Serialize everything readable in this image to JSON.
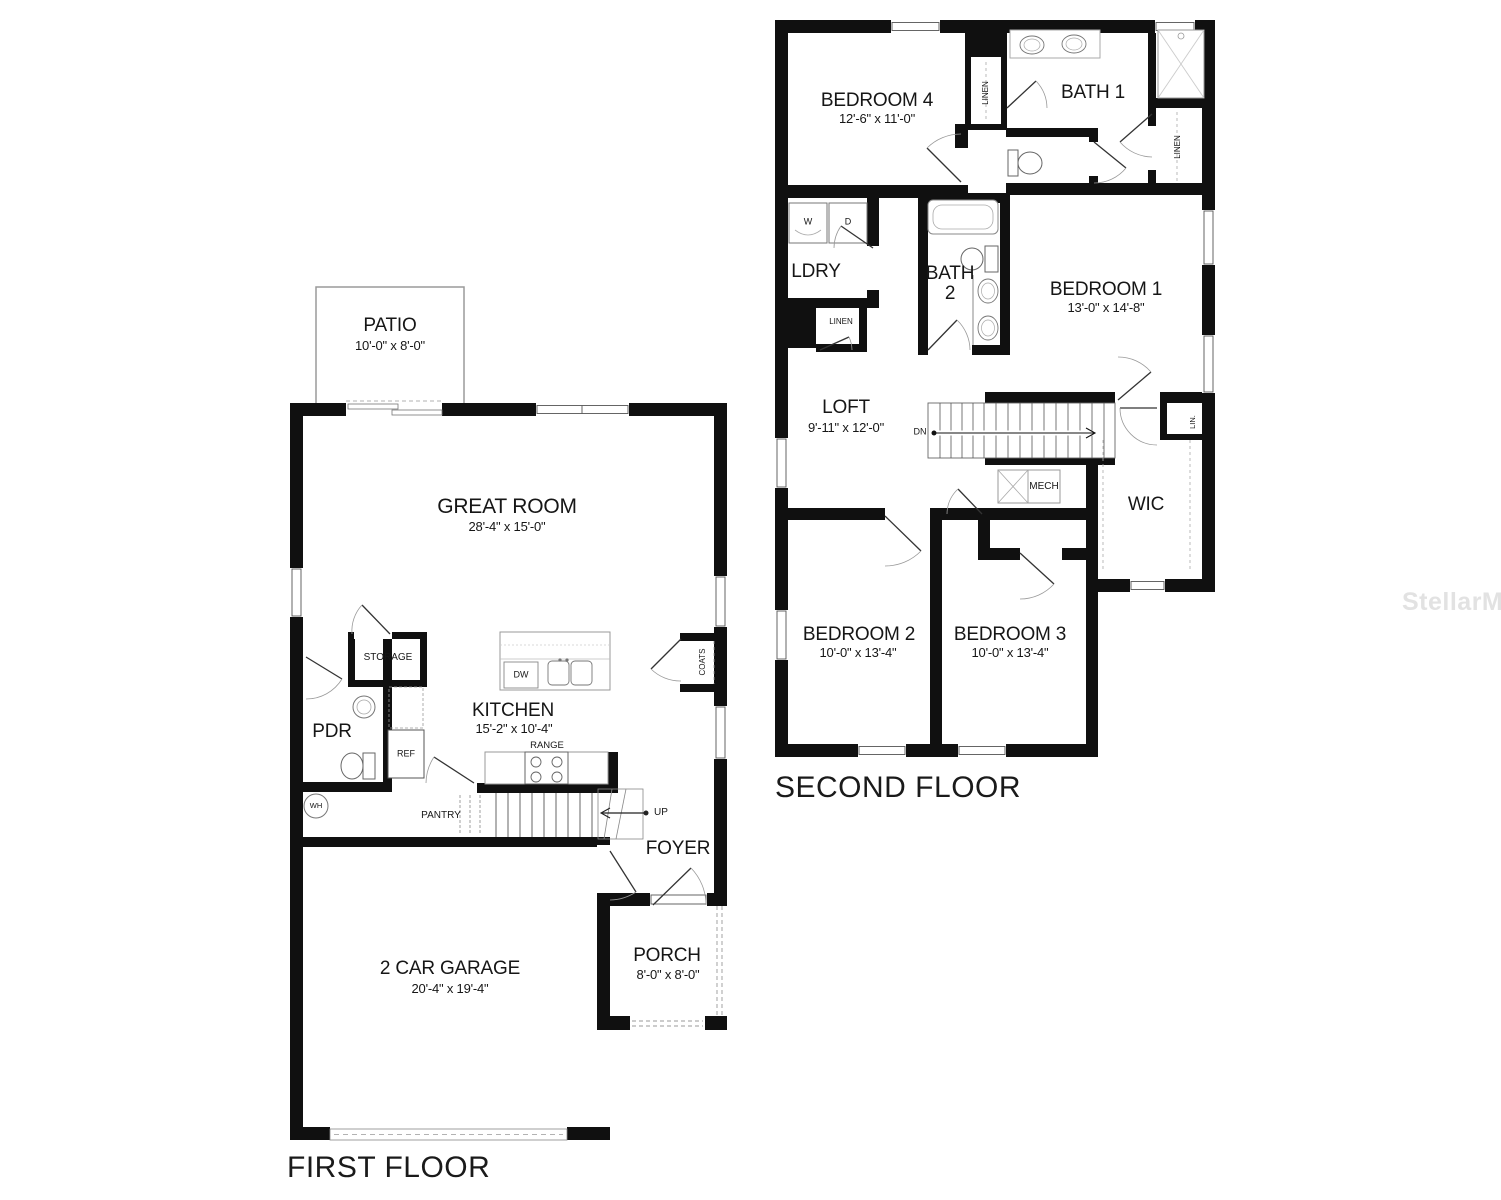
{
  "watermark": "StellarMLS",
  "first_floor": {
    "title": "FIRST FLOOR",
    "rooms": {
      "patio": {
        "name": "PATIO",
        "dims": "10'-0\" x 8'-0\""
      },
      "great_room": {
        "name": "GREAT ROOM",
        "dims": "28'-4\" x 15'-0\""
      },
      "kitchen": {
        "name": "KITCHEN",
        "dims": "15'-2\" x 10'-4\""
      },
      "garage": {
        "name": "2 CAR GARAGE",
        "dims": "20'-4\" x 19'-4\""
      },
      "porch": {
        "name": "PORCH",
        "dims": "8'-0\" x 8'-0\""
      },
      "pdr": {
        "name": "PDR"
      },
      "foyer": {
        "name": "FOYER"
      },
      "storage": {
        "name": "STORAGE"
      },
      "pantry": {
        "name": "PANTRY"
      },
      "coats": {
        "name": "COATS"
      }
    },
    "fixtures": {
      "ref": "REF",
      "dw": "DW",
      "range": "RANGE",
      "wh": "WH",
      "up": "UP"
    }
  },
  "second_floor": {
    "title": "SECOND FLOOR",
    "rooms": {
      "bedroom1": {
        "name": "BEDROOM 1",
        "dims": "13'-0\" x 14'-8\""
      },
      "bedroom2": {
        "name": "BEDROOM 2",
        "dims": "10'-0\" x 13'-4\""
      },
      "bedroom3": {
        "name": "BEDROOM 3",
        "dims": "10'-0\" x 13'-4\""
      },
      "bedroom4": {
        "name": "BEDROOM 4",
        "dims": "12'-6\" x 11'-0\""
      },
      "loft": {
        "name": "LOFT",
        "dims": "9'-11\" x 12'-0\""
      },
      "bath1": {
        "name": "BATH 1"
      },
      "bath2": {
        "name": "BATH 2"
      },
      "ldry": {
        "name": "LDRY"
      },
      "wic": {
        "name": "WIC"
      },
      "mech": {
        "name": "MECH"
      }
    },
    "fixtures": {
      "w": "W",
      "d": "D",
      "dn": "DN",
      "linen_hall": "LINEN",
      "linen_bath1": "LINEN",
      "linen_ldry": "LINEN",
      "lin": "LIN."
    }
  }
}
